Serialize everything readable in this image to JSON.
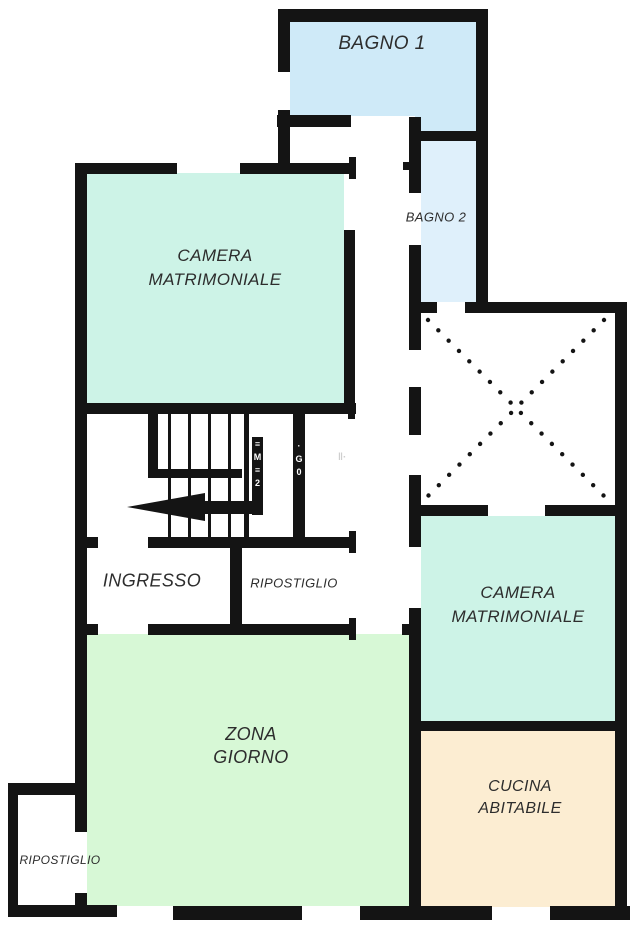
{
  "plan_title": "floor-plan",
  "rooms": {
    "bagno1": {
      "label": "BAGNO 1"
    },
    "bagno2": {
      "label": "BAGNO 2"
    },
    "camera1": {
      "line1": "CAMERA",
      "line2": "MATRIMONIALE"
    },
    "ingresso": {
      "label": "INGRESSO"
    },
    "ripostiglio_hall": {
      "label": "RIPOSTIGLIO"
    },
    "camera2": {
      "line1": "CAMERA",
      "line2": "MATRIMONIALE"
    },
    "zona_giorno": {
      "line1": "ZONA",
      "line2": "GIORNO"
    },
    "cucina": {
      "line1": "CUCINA",
      "line2": "ABITABILE"
    },
    "ripostiglio_small": {
      "label": "RIPOSTIGLIO"
    }
  },
  "colors": {
    "bagno1": "#cfeaf8",
    "bagno2": "#dff0fb",
    "bedroom": "#cdf3e7",
    "living": "#d7f8d6",
    "kitchen": "#fcedd2",
    "wall": "#141414",
    "label": "#2d2d2d"
  },
  "watermark": {
    "bar1": [
      "≡",
      "M",
      "≡",
      "2"
    ],
    "bar2": [
      "·",
      "G",
      "0"
    ],
    "faint": "‖·"
  }
}
